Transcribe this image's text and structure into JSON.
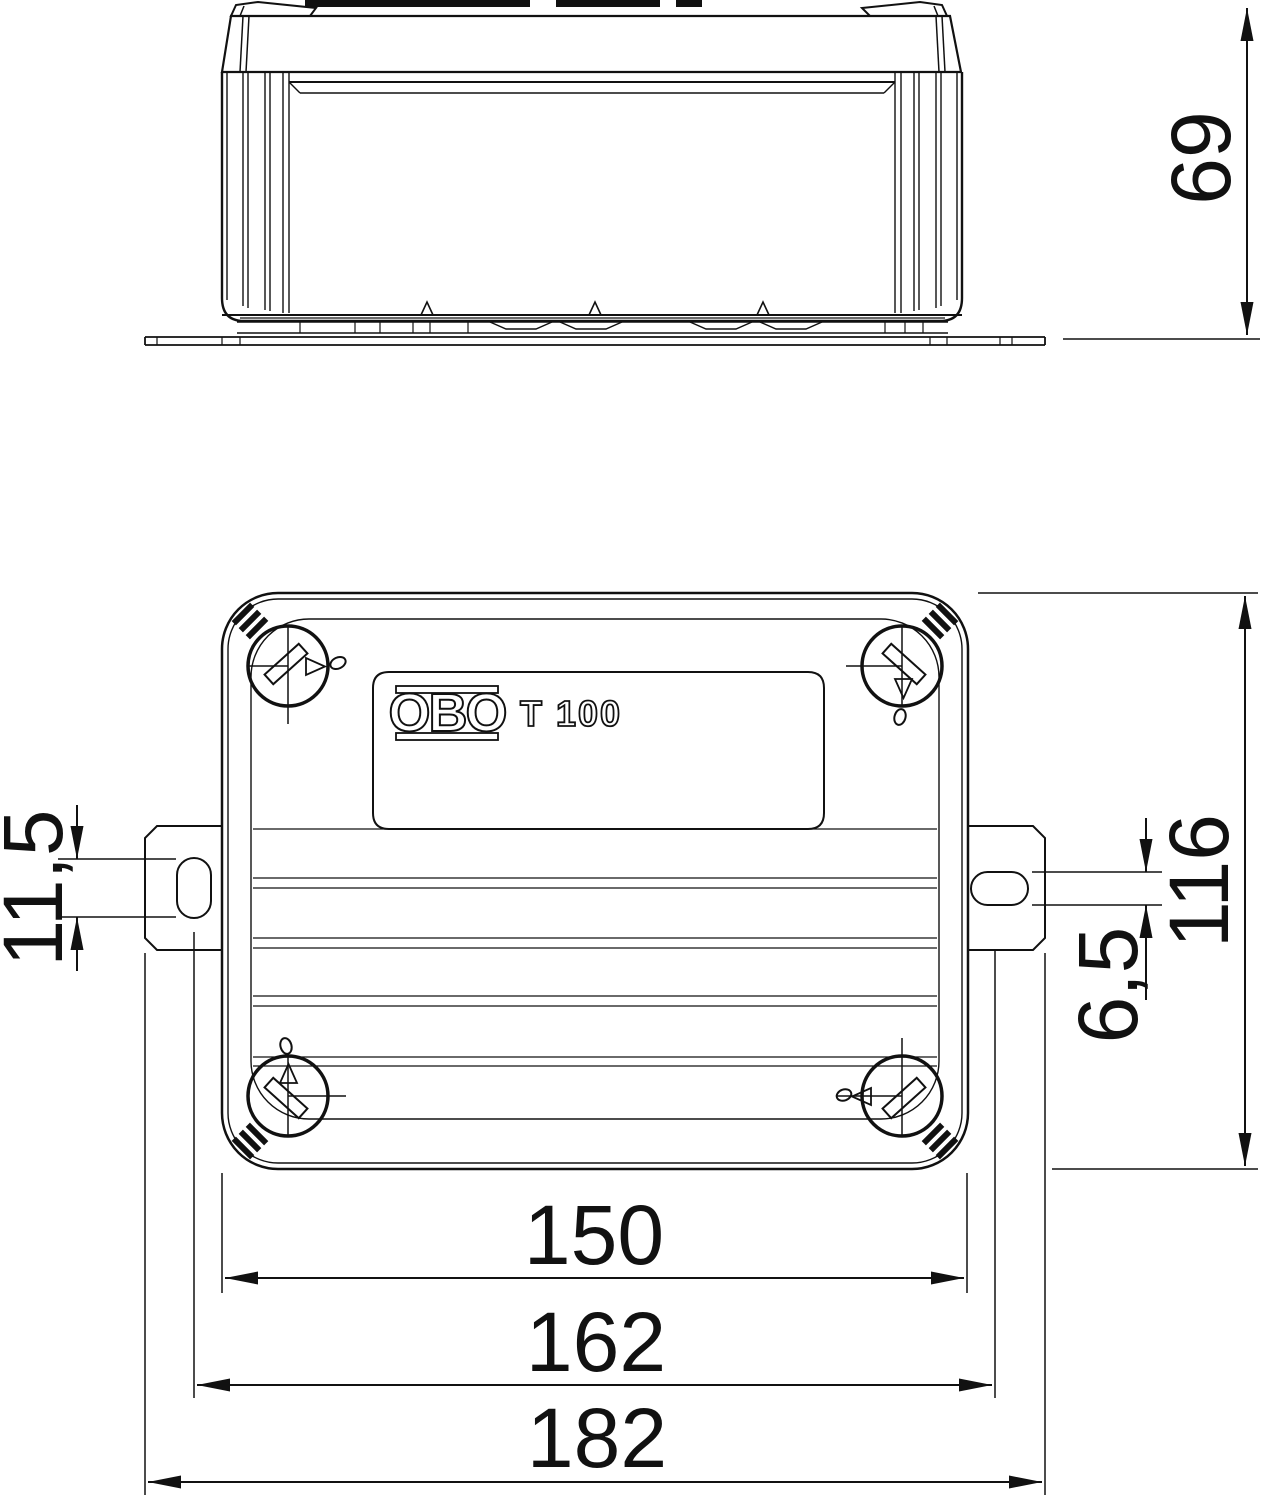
{
  "drawing": {
    "brand": "OBO",
    "model": "T 100",
    "dims": {
      "side_height": "69",
      "plan_height": "116",
      "slot_length": "11,5",
      "slot_width": "6,5",
      "body_width": "150",
      "slot_center_span": "162",
      "overall_width": "182"
    }
  }
}
